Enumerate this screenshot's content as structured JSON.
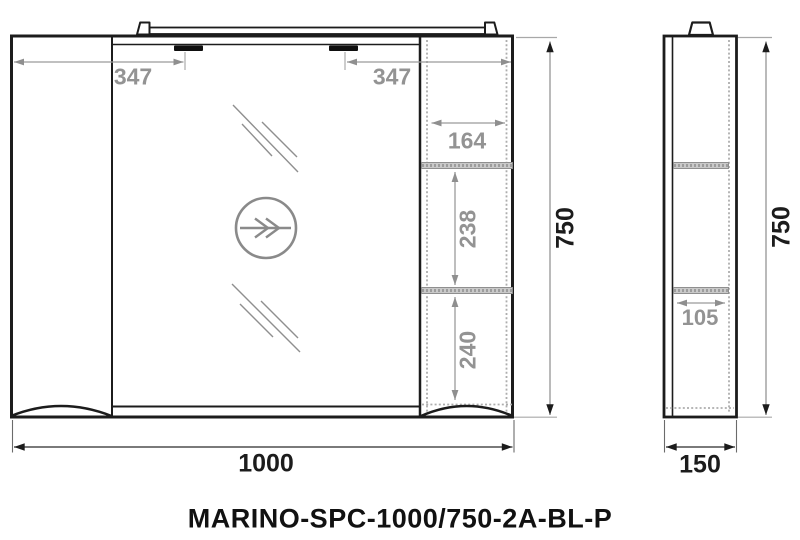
{
  "title": "MARINO-SPC-1000/750-2A-BL-P",
  "front_view": {
    "dims": {
      "light_offset_left": "347",
      "light_offset_right": "347",
      "open_shelf_width": "164",
      "shelf_section_upper": "238",
      "shelf_section_lower": "240",
      "overall_height": "750",
      "overall_width": "1000"
    }
  },
  "side_view": {
    "dims": {
      "shelf_depth": "105",
      "overall_height": "750",
      "overall_depth": "150"
    }
  },
  "colors": {
    "line": "#1c1c1c",
    "dim_gray": "#939393",
    "dim_black": "#1c1c1c",
    "shelf_fill": "#c9c9c9",
    "background": "#ffffff"
  }
}
